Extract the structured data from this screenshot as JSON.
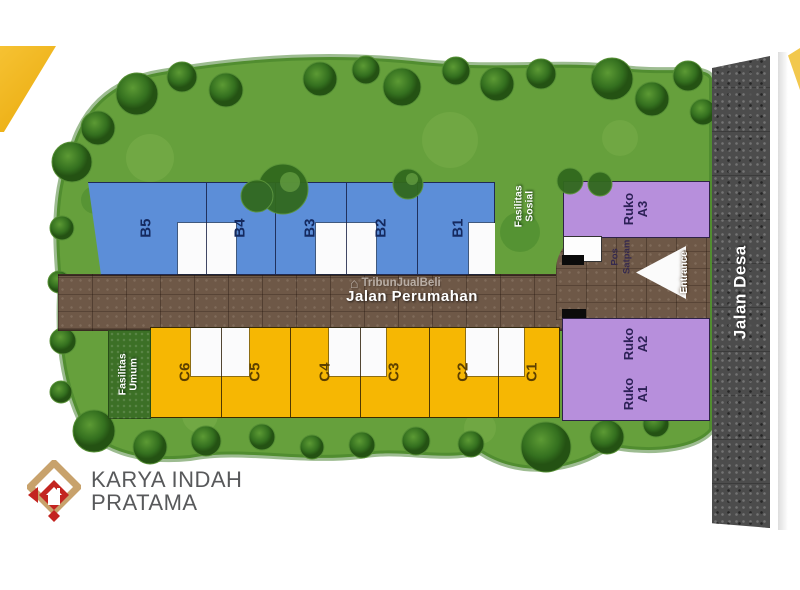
{
  "roads": {
    "perumahan": "Jalan Perumahan",
    "desa": "Jalan Desa"
  },
  "blocks": {
    "b": [
      {
        "label": "B5"
      },
      {
        "label": "B4"
      },
      {
        "label": "B3"
      },
      {
        "label": "B2"
      },
      {
        "label": "B1"
      }
    ],
    "c": [
      {
        "label": "C6"
      },
      {
        "label": "C5"
      },
      {
        "label": "C4"
      },
      {
        "label": "C3"
      },
      {
        "label": "C2"
      },
      {
        "label": "C1"
      }
    ]
  },
  "ruko": {
    "a3": {
      "line1": "Ruko",
      "line2": "A3"
    },
    "a2": {
      "line1": "Ruko",
      "line2": "A2"
    },
    "a1": {
      "line1": "Ruko",
      "line2": "A1"
    }
  },
  "facilities": {
    "sosial": {
      "line1": "Fasilitas",
      "line2": "Sosial"
    },
    "umum": {
      "line1": "Fasilitas",
      "line2": "Umum"
    }
  },
  "guard_post": {
    "line1": "Pos",
    "line2": "Satpam"
  },
  "entrance_label": "Entrance",
  "watermark": {
    "icon": "home-icon",
    "text": "TribunJualBeli"
  },
  "developer": {
    "name_line1": "KARYA INDAH",
    "name_line2": "PRATAMA"
  },
  "colors": {
    "block_b": "#5c8ed8",
    "block_c": "#f6b703",
    "ruko": "#b78fdc",
    "road_main": "#6e5847",
    "road_desa": "#4c4c4c",
    "green": "#66a03c",
    "logo_red": "#c32420",
    "logo_gold": "#c8a26c"
  }
}
